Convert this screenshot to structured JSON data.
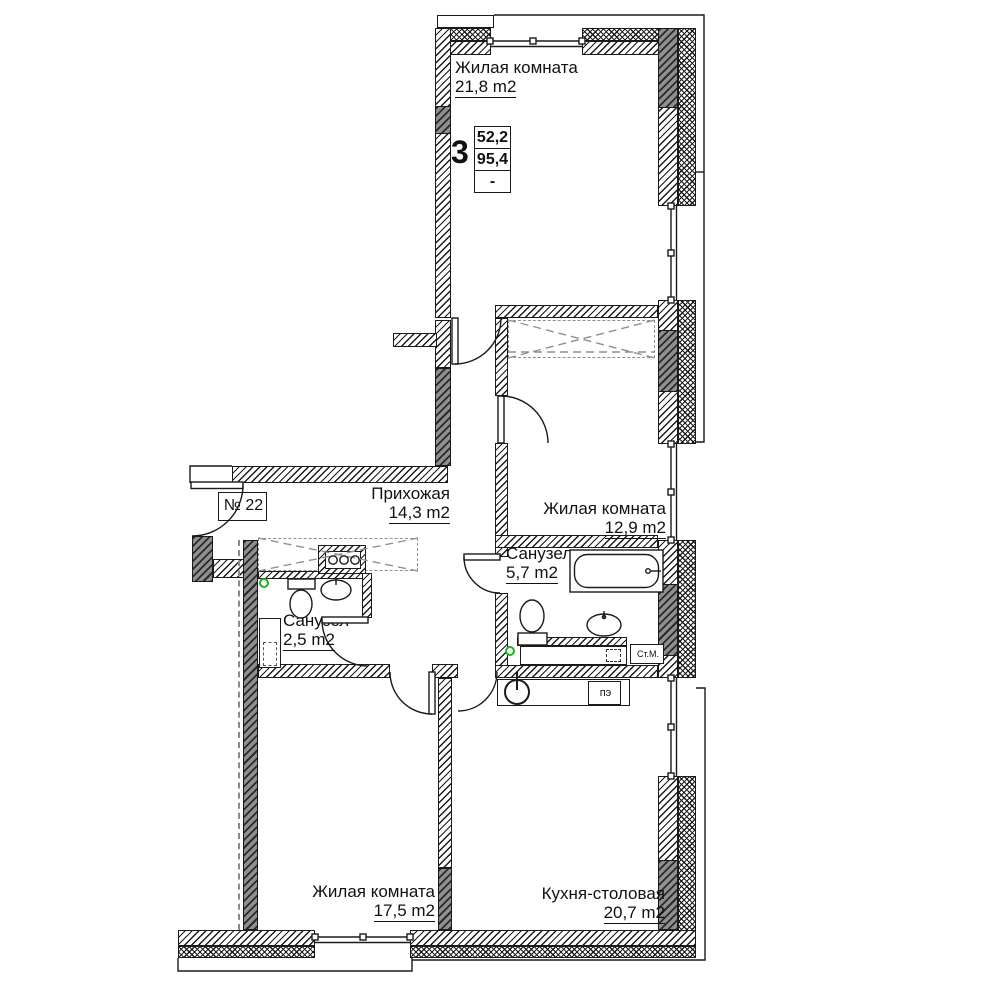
{
  "plan": {
    "apartment_number": "№ 22",
    "stamp": {
      "rooms_count": "3",
      "living_area": "52,2",
      "total_area": "95,4",
      "dash": "-"
    },
    "rooms": {
      "living_top": {
        "name": "Жилая комната",
        "area": "21,8 m2"
      },
      "hallway": {
        "name": "Прихожая",
        "area": "14,3 m2"
      },
      "living_mid": {
        "name": "Жилая комната",
        "area": "12,9 m2"
      },
      "bath_big": {
        "name": "Санузел",
        "area": "5,7 m2"
      },
      "bath_small": {
        "name": "Санузел",
        "area": "2,5 m2"
      },
      "living_bottom": {
        "name": "Жилая комната",
        "area": "17,5 m2"
      },
      "kitchen": {
        "name": "Кухня-столовая",
        "area": "20,7 m2"
      }
    },
    "appliances": {
      "washing_machine": "Ст.М.",
      "stove": "пэ"
    },
    "colors": {
      "line": "#1a1a1a",
      "marker_green": "#1db31d",
      "furniture_dash": "#8f8f8f"
    }
  }
}
